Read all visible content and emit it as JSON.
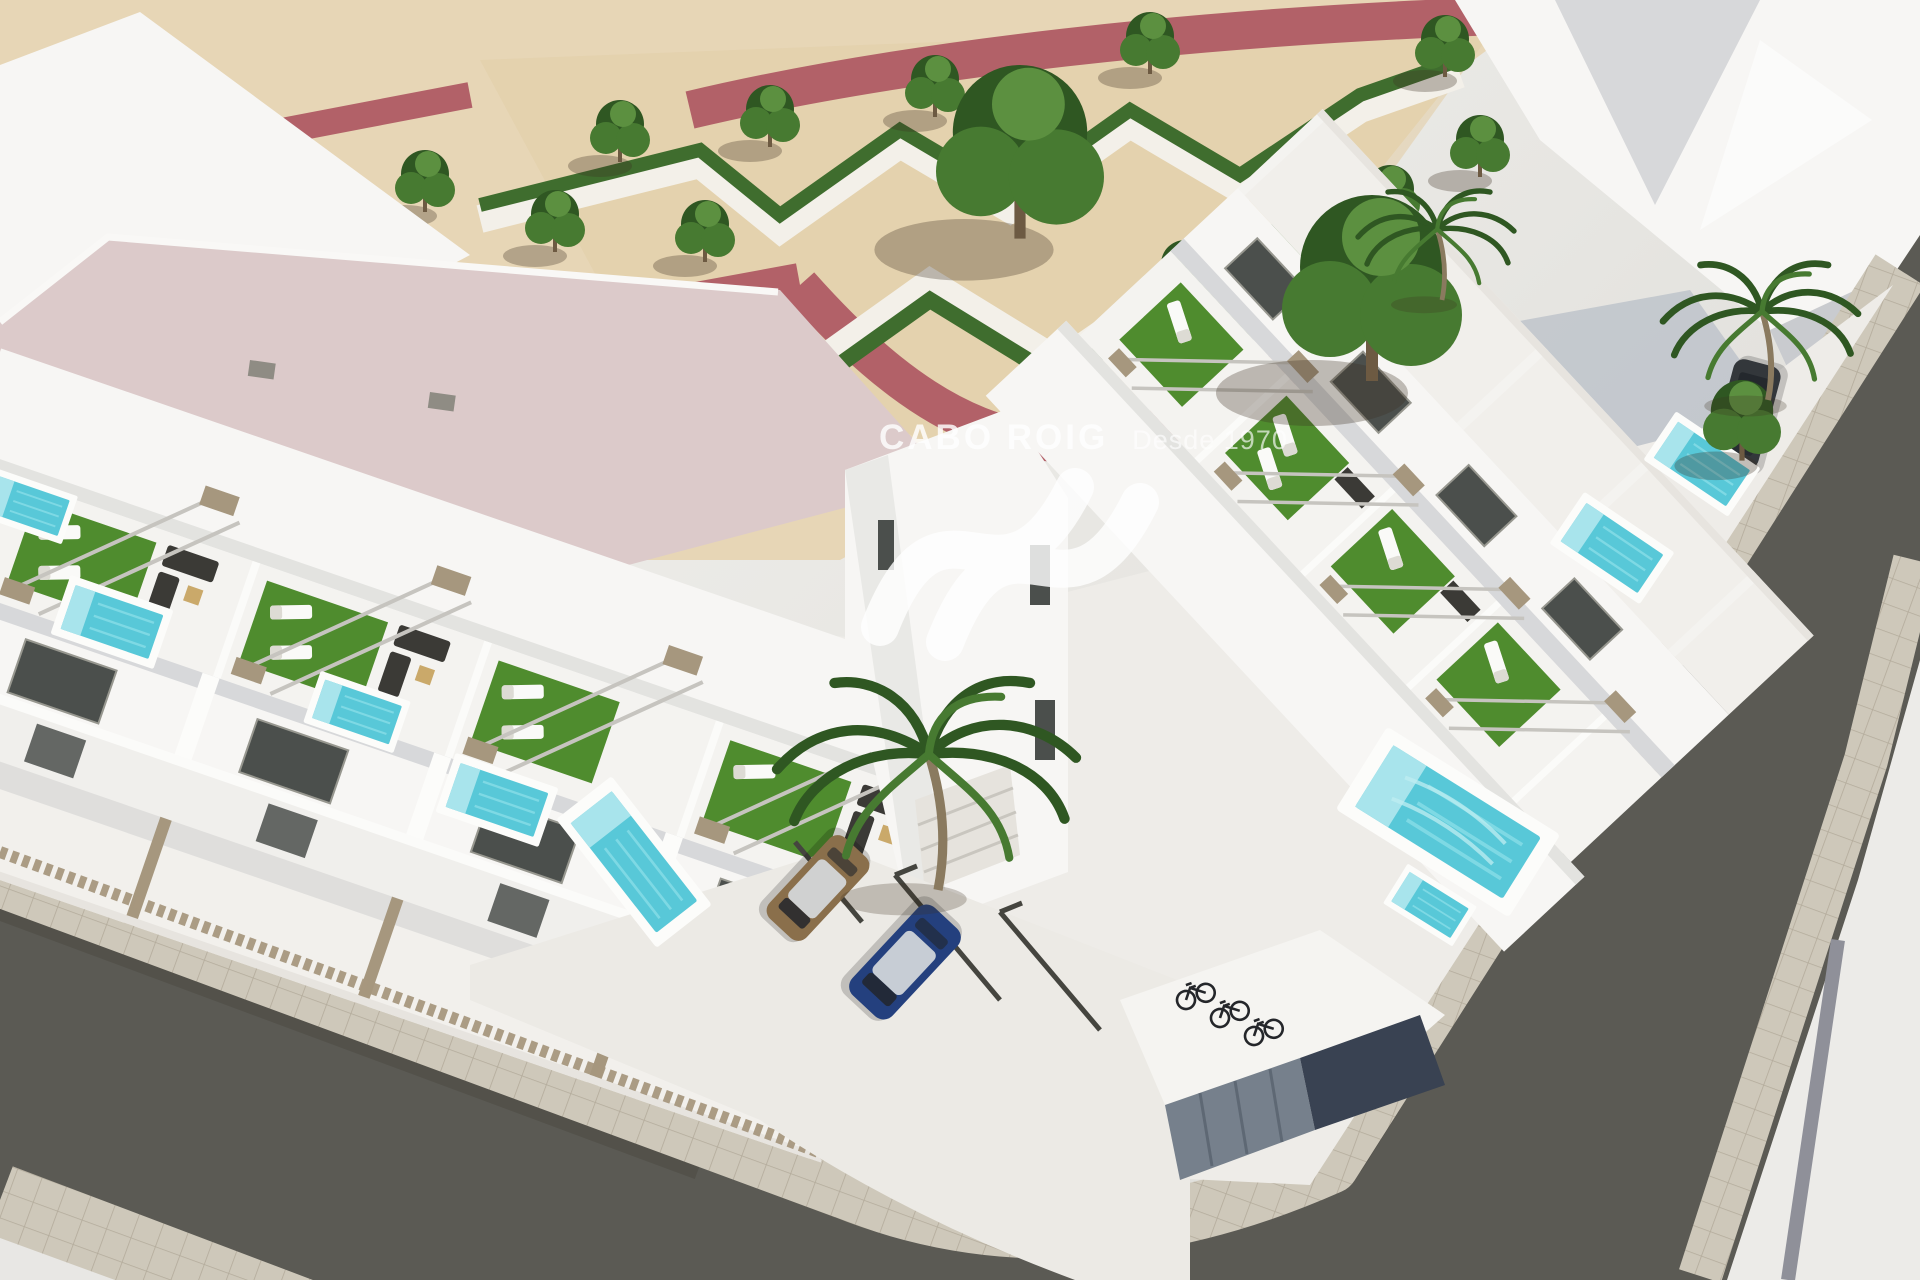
{
  "image": {
    "kind": "3d-architectural-render",
    "view": "aerial corner view of a modern white townhouse development with rooftop solariums, private pools, landscaped park and surrounding streets"
  },
  "watermark": {
    "brand": "CABO ROIG",
    "tagline": "Desde 1970",
    "logo": "sv-wave-logo",
    "color": "#ffffff"
  },
  "inventory": {
    "townhouse_rows": 2,
    "rooftop_solariums": 8,
    "private_pools": 9,
    "palm_trees": 3,
    "park_trees": 15,
    "large_trees": 2,
    "bicycles": 3,
    "cars": [
      "blue",
      "bronze",
      "dark-gray"
    ],
    "streets": 2
  },
  "palette": {
    "sand": "#e7d6b6",
    "sandDeep": "#e2cfa9",
    "redPath": "#b26168",
    "pinkRoof": "#dccaca",
    "cream": "#e2d8c8",
    "hedge": "#3f6d2e",
    "treeDark": "#2f5722",
    "treeMid": "#477a31",
    "treeLight": "#5c9040",
    "turf": "#4f8c2e",
    "white": "#f7f6f4",
    "whiteShade": "#e3e3e0",
    "facetGray": "#d7d8da",
    "wallShadow": "#c9cbcf",
    "plot": "#eeece8",
    "driveway": "#eceae5",
    "glass": "#4b4f4c",
    "fence": "#a6977e",
    "pool": "#58c8d8",
    "poolStep": "#a8e4ec",
    "asphalt": "#5b5a54",
    "roadShadow": "#49483f",
    "sidewalk": "#cec8ba",
    "sidewalkLine": "#b3ab9b",
    "carBlue": "#24407e",
    "carBronze": "#8a6f4b",
    "carDark": "#33373b",
    "metalDoor": "#76808c",
    "shadowNavy": "#394252",
    "trunk": "#6d5a42",
    "palmTrunk": "#8a7a5f"
  }
}
